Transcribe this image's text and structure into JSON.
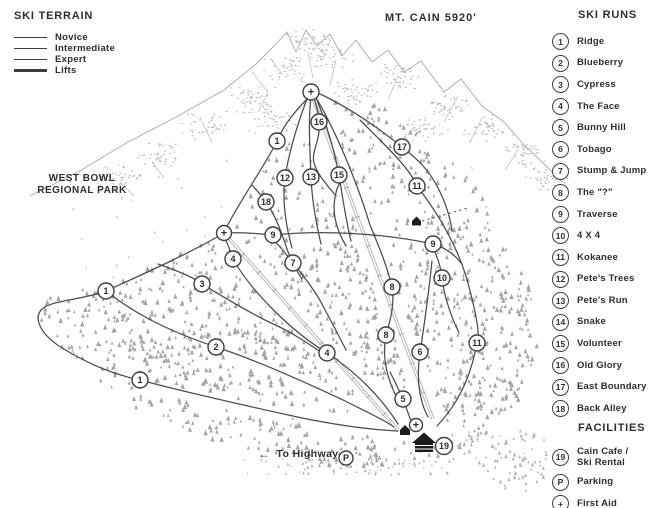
{
  "title": "MT. CAIN 5920'",
  "terrain_legend": {
    "heading": "SKI TERRAIN",
    "items": [
      {
        "label": "Novice",
        "weight": 1.1
      },
      {
        "label": "Intermediate",
        "weight": 1.5
      },
      {
        "label": "Expert",
        "weight": 1.9
      },
      {
        "label": "Lifts",
        "weight": 2.2
      }
    ]
  },
  "ski_runs": {
    "heading": "SKI RUNS",
    "items": [
      {
        "num": "1",
        "label": "Ridge"
      },
      {
        "num": "2",
        "label": "Blueberry"
      },
      {
        "num": "3",
        "label": "Cypress"
      },
      {
        "num": "4",
        "label": "The Face"
      },
      {
        "num": "5",
        "label": "Bunny Hill"
      },
      {
        "num": "6",
        "label": "Tobago"
      },
      {
        "num": "7",
        "label": "Stump & Jump"
      },
      {
        "num": "8",
        "label": "The \"?\""
      },
      {
        "num": "9",
        "label": "Traverse"
      },
      {
        "num": "10",
        "label": "4 X 4"
      },
      {
        "num": "11",
        "label": "Kokanee"
      },
      {
        "num": "12",
        "label": "Pete's Trees"
      },
      {
        "num": "13",
        "label": "Pete's Run"
      },
      {
        "num": "14",
        "label": "Snake"
      },
      {
        "num": "15",
        "label": "Volunteer"
      },
      {
        "num": "16",
        "label": "Old Glory"
      },
      {
        "num": "17",
        "label": "East Boundary"
      },
      {
        "num": "18",
        "label": "Back Alley"
      }
    ]
  },
  "facilities": {
    "heading": "FACILITIES",
    "items": [
      {
        "num": "19",
        "label": "Cain Cafe /\nSki Rental"
      },
      {
        "num": "P",
        "label": "Parking"
      },
      {
        "num": "+",
        "label": "First Aid"
      }
    ]
  },
  "map_labels": {
    "west_bowl_line1": "WEST BOWL",
    "west_bowl_line2": "REGIONAL PARK",
    "to_highway_arrow": "←",
    "to_highway": "To Highway"
  },
  "map_markers": [
    {
      "label": "+",
      "x": 311,
      "y": 92,
      "r": 8
    },
    {
      "label": "16",
      "x": 319,
      "y": 122,
      "r": 8
    },
    {
      "label": "1",
      "x": 277,
      "y": 141,
      "r": 8
    },
    {
      "label": "17",
      "x": 402,
      "y": 147,
      "r": 8
    },
    {
      "label": "15",
      "x": 339,
      "y": 175,
      "r": 8
    },
    {
      "label": "13",
      "x": 311,
      "y": 177,
      "r": 8
    },
    {
      "label": "12",
      "x": 285,
      "y": 178,
      "r": 8
    },
    {
      "label": "11",
      "x": 417,
      "y": 186,
      "r": 8
    },
    {
      "label": "18",
      "x": 266,
      "y": 202,
      "r": 8
    },
    {
      "label": "+",
      "x": 224,
      "y": 233,
      "r": 7.5
    },
    {
      "label": "9",
      "x": 273,
      "y": 235,
      "r": 8
    },
    {
      "label": "9",
      "x": 433,
      "y": 244,
      "r": 8
    },
    {
      "label": "4",
      "x": 233,
      "y": 259,
      "r": 8
    },
    {
      "label": "7",
      "x": 293,
      "y": 263,
      "r": 8
    },
    {
      "label": "10",
      "x": 442,
      "y": 278,
      "r": 8
    },
    {
      "label": "3",
      "x": 202,
      "y": 284,
      "r": 8
    },
    {
      "label": "8",
      "x": 392,
      "y": 287,
      "r": 8
    },
    {
      "label": "1",
      "x": 106,
      "y": 291,
      "r": 8
    },
    {
      "label": "8",
      "x": 386,
      "y": 335,
      "r": 8
    },
    {
      "label": "11",
      "x": 477,
      "y": 343,
      "r": 8
    },
    {
      "label": "2",
      "x": 216,
      "y": 347,
      "r": 8
    },
    {
      "label": "6",
      "x": 420,
      "y": 352,
      "r": 8
    },
    {
      "label": "4",
      "x": 327,
      "y": 353,
      "r": 8
    },
    {
      "label": "1",
      "x": 140,
      "y": 380,
      "r": 8
    },
    {
      "label": "5",
      "x": 403,
      "y": 399,
      "r": 8
    },
    {
      "label": "+",
      "x": 416,
      "y": 425,
      "r": 6.5
    },
    {
      "label": "19",
      "x": 444,
      "y": 446,
      "r": 8.5
    },
    {
      "label": "P",
      "x": 346,
      "y": 458,
      "r": 7
    }
  ],
  "colors": {
    "text": "#2e2e2e",
    "trail": "#4c4c4c",
    "trees": "#9d9d9d",
    "ridge_sketch": "#a9a9a9",
    "lift": "#b2b2b2",
    "background": "#ffffff"
  }
}
